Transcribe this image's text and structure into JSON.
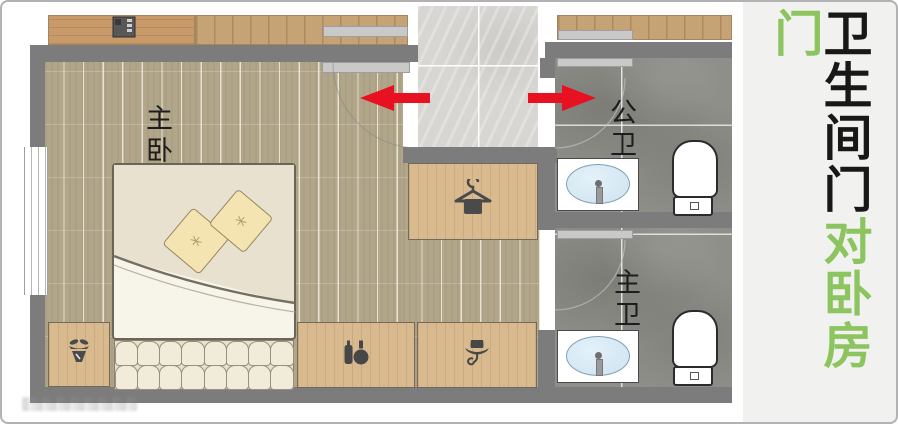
{
  "sidebar": {
    "heading_black": "卫生间门",
    "heading_green": "对卧房门"
  },
  "rooms": {
    "bedroom": "主卧",
    "public_bathroom": "公卫",
    "master_bathroom": "主卫"
  },
  "colors": {
    "arrow_red": "#e81122",
    "heading_green": "#8cc45f",
    "heading_black": "#181818",
    "wall_gray": "#7c7c7c",
    "bedroom_wood": "#b1a58a",
    "cabinet_wood": "#d9ba8f",
    "corridor_tile": "#d8d6d2",
    "bath_tile": "#8f8f8a",
    "basin_blue": "#d4e7f3",
    "sidebar_bg": "#f1f1ef"
  }
}
